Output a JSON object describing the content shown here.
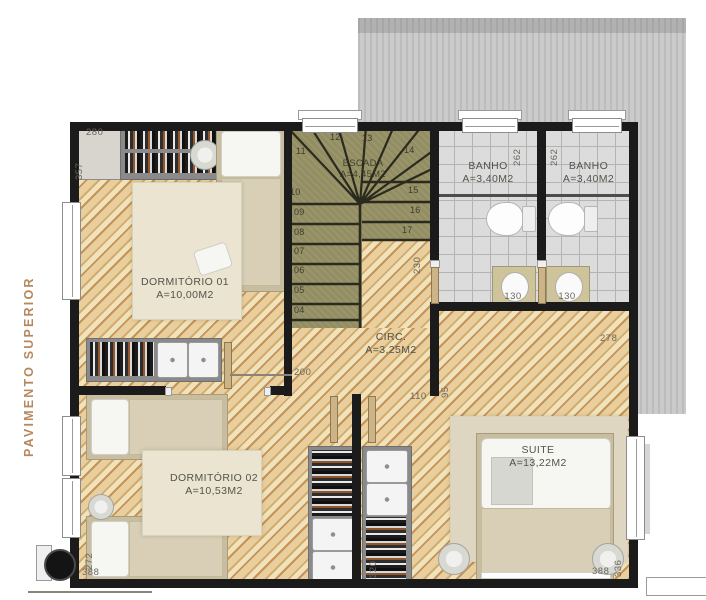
{
  "plan": {
    "floor_label": "PAVIMENTO SUPERIOR",
    "rooms": {
      "dorm1": {
        "name": "DORMITÓRIO 01",
        "area": "A=10,00M2"
      },
      "dorm2": {
        "name": "DORMITÓRIO 02",
        "area": "A=10,53M2"
      },
      "suite": {
        "name": "SUITE",
        "area": "A=13,22M2"
      },
      "banho1": {
        "name": "BANHO",
        "area": "A=3,40M2"
      },
      "banho2": {
        "name": "BANHO",
        "area": "A=3,40M2"
      },
      "circ": {
        "name": "CIRC.",
        "area": "A=3,25M2"
      },
      "escada": {
        "name": "ESCADA",
        "area": "A=4,45M2"
      }
    },
    "stairs": {
      "steps": [
        "04",
        "05",
        "06",
        "07",
        "08",
        "09",
        "10",
        "11",
        "12",
        "13",
        "14",
        "15",
        "16",
        "17"
      ]
    },
    "dims": {
      "dorm1_width": "280",
      "dorm1_depth": "357",
      "banho1_depth": "262",
      "banho2_depth": "262",
      "banho1_vanity": "130",
      "banho2_vanity": "130",
      "stair_void": "230",
      "circ_length": "200",
      "circ_door": "110",
      "circ_depth": "95",
      "suite_top": "278",
      "suite_closet": "320",
      "dorm2_depth": "272",
      "dorm2_width": "388",
      "suite_depth": "336",
      "suite_width": "388"
    },
    "colors": {
      "wall": "#1b1b1b",
      "wood_light": "#f0e3bb",
      "wood_dark": "#c59257",
      "stair_tread": "#938d62",
      "bath_tile": "#dcdcdc",
      "roof": "#c9c9c9",
      "floor_label": "#b5885f"
    }
  }
}
